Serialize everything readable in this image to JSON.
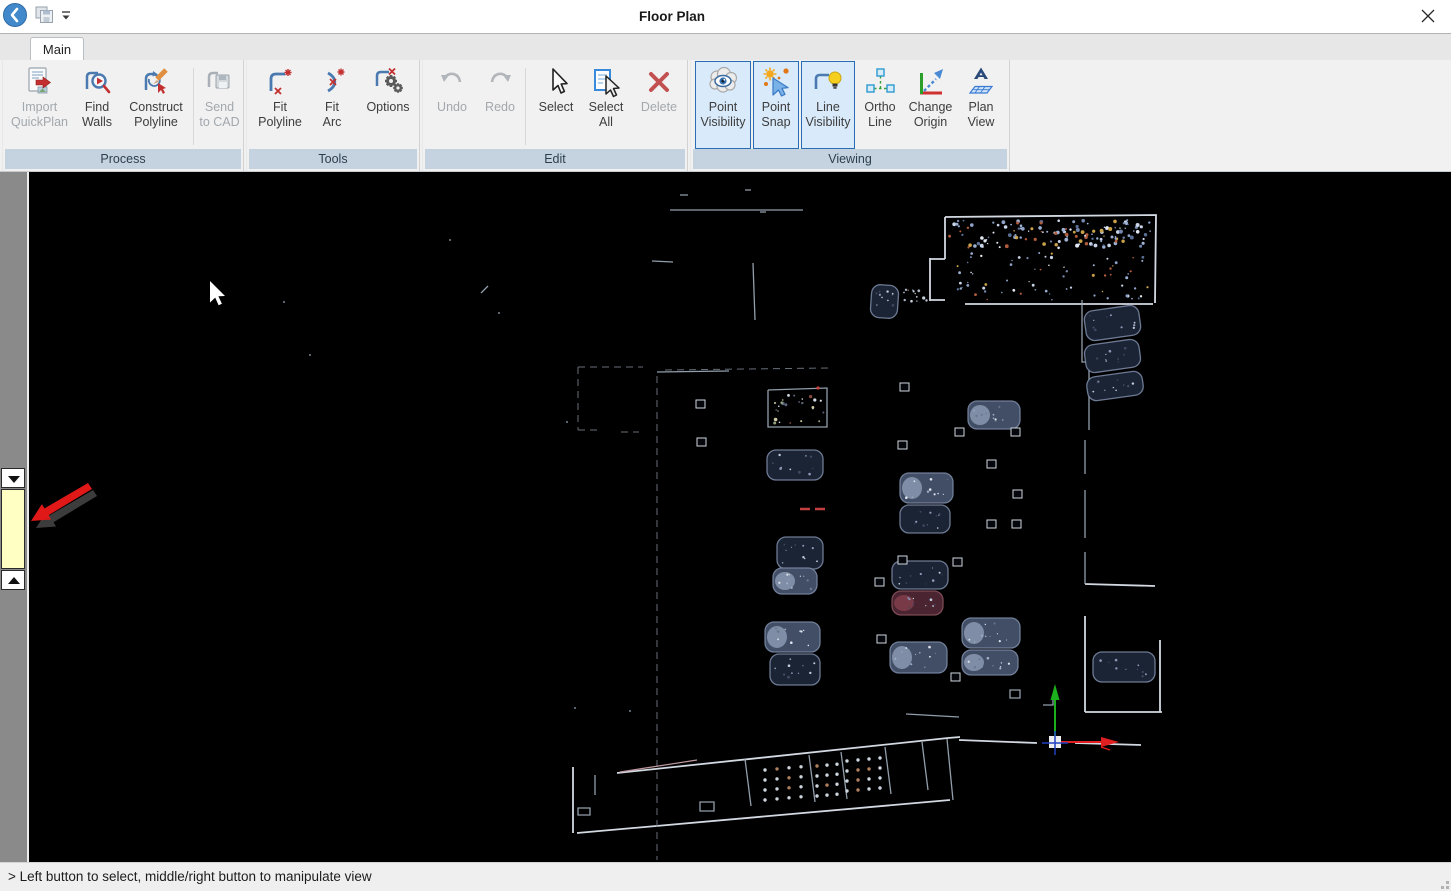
{
  "window": {
    "title": "Floor Plan",
    "back_icon": "back-chevron-icon",
    "qat_save_icon": "save-icon",
    "qat_menu_icon": "dropdown-caret-icon",
    "close_icon": "close-x-icon"
  },
  "tabs": [
    {
      "label": "Main"
    }
  ],
  "ribbon": {
    "groups": [
      {
        "name": "Process",
        "buttons": [
          {
            "id": "import-quickplan",
            "lines": [
              "Import",
              "QuickPlan"
            ],
            "state": "disabled",
            "icon": "import-quickplan-icon"
          },
          {
            "id": "find-walls",
            "lines": [
              "Find",
              "Walls"
            ],
            "state": "normal",
            "icon": "find-walls-icon"
          },
          {
            "id": "construct-polyline",
            "lines": [
              "Construct",
              "Polyline"
            ],
            "state": "normal",
            "icon": "construct-polyline-icon"
          },
          {
            "id": "send-to-cad",
            "lines": [
              "Send",
              "to CAD"
            ],
            "state": "disabled",
            "icon": "send-to-cad-icon"
          }
        ]
      },
      {
        "name": "Tools",
        "buttons": [
          {
            "id": "fit-polyline",
            "lines": [
              "Fit",
              "Polyline"
            ],
            "state": "normal",
            "icon": "fit-polyline-icon"
          },
          {
            "id": "fit-arc",
            "lines": [
              "Fit",
              "Arc"
            ],
            "state": "normal",
            "icon": "fit-arc-icon"
          },
          {
            "id": "options",
            "lines": [
              "Options"
            ],
            "state": "normal",
            "icon": "options-icon"
          }
        ]
      },
      {
        "name": "Edit",
        "buttons": [
          {
            "id": "undo",
            "lines": [
              "Undo"
            ],
            "state": "disabled",
            "icon": "undo-icon"
          },
          {
            "id": "redo",
            "lines": [
              "Redo"
            ],
            "state": "disabled",
            "icon": "redo-icon"
          },
          {
            "id": "select",
            "lines": [
              "Select"
            ],
            "state": "normal",
            "icon": "select-icon"
          },
          {
            "id": "select-all",
            "lines": [
              "Select",
              "All"
            ],
            "state": "normal",
            "icon": "select-all-icon"
          },
          {
            "id": "delete",
            "lines": [
              "Delete"
            ],
            "state": "disabled",
            "icon": "delete-icon"
          }
        ]
      },
      {
        "name": "Viewing",
        "buttons": [
          {
            "id": "point-visibility",
            "lines": [
              "Point",
              "Visibility"
            ],
            "state": "toggled",
            "icon": "point-visibility-icon"
          },
          {
            "id": "point-snap",
            "lines": [
              "Point",
              "Snap"
            ],
            "state": "toggled",
            "icon": "point-snap-icon"
          },
          {
            "id": "line-visibility",
            "lines": [
              "Line",
              "Visibility"
            ],
            "state": "toggled",
            "icon": "line-visibility-icon"
          },
          {
            "id": "ortho-line",
            "lines": [
              "Ortho",
              "Line"
            ],
            "state": "normal",
            "icon": "ortho-line-icon"
          },
          {
            "id": "change-origin",
            "lines": [
              "Change",
              "Origin"
            ],
            "state": "normal",
            "icon": "change-origin-icon"
          },
          {
            "id": "plan-view",
            "lines": [
              "Plan",
              "View"
            ],
            "state": "normal",
            "icon": "plan-view-icon"
          }
        ]
      }
    ]
  },
  "sidebar": {
    "scroll_down_icon": "triangle-down-icon",
    "scroll_up_icon": "triangle-up-icon",
    "slider_name": "level-slider"
  },
  "canvas": {
    "annotation": "red-arrow-pointing-to-level-slider",
    "cursor": "mouse-cursor-arrow",
    "origin_indicator": "coordinate-origin-axes"
  },
  "statusbar": {
    "text": "> Left button to select, middle/right button to manipulate view"
  },
  "colors": {
    "toggle_border": "#2a6db4",
    "toggle_bg": "#d9eafa",
    "group_strip_bg": "#c5d3e0",
    "canvas_bg": "#000000",
    "slider_yellow": "#ffffc4",
    "axis_x_red": "#e02020",
    "axis_y_green": "#1cb01c",
    "annotation_red": "#e01818",
    "back_button_blue": "#4289cb"
  }
}
